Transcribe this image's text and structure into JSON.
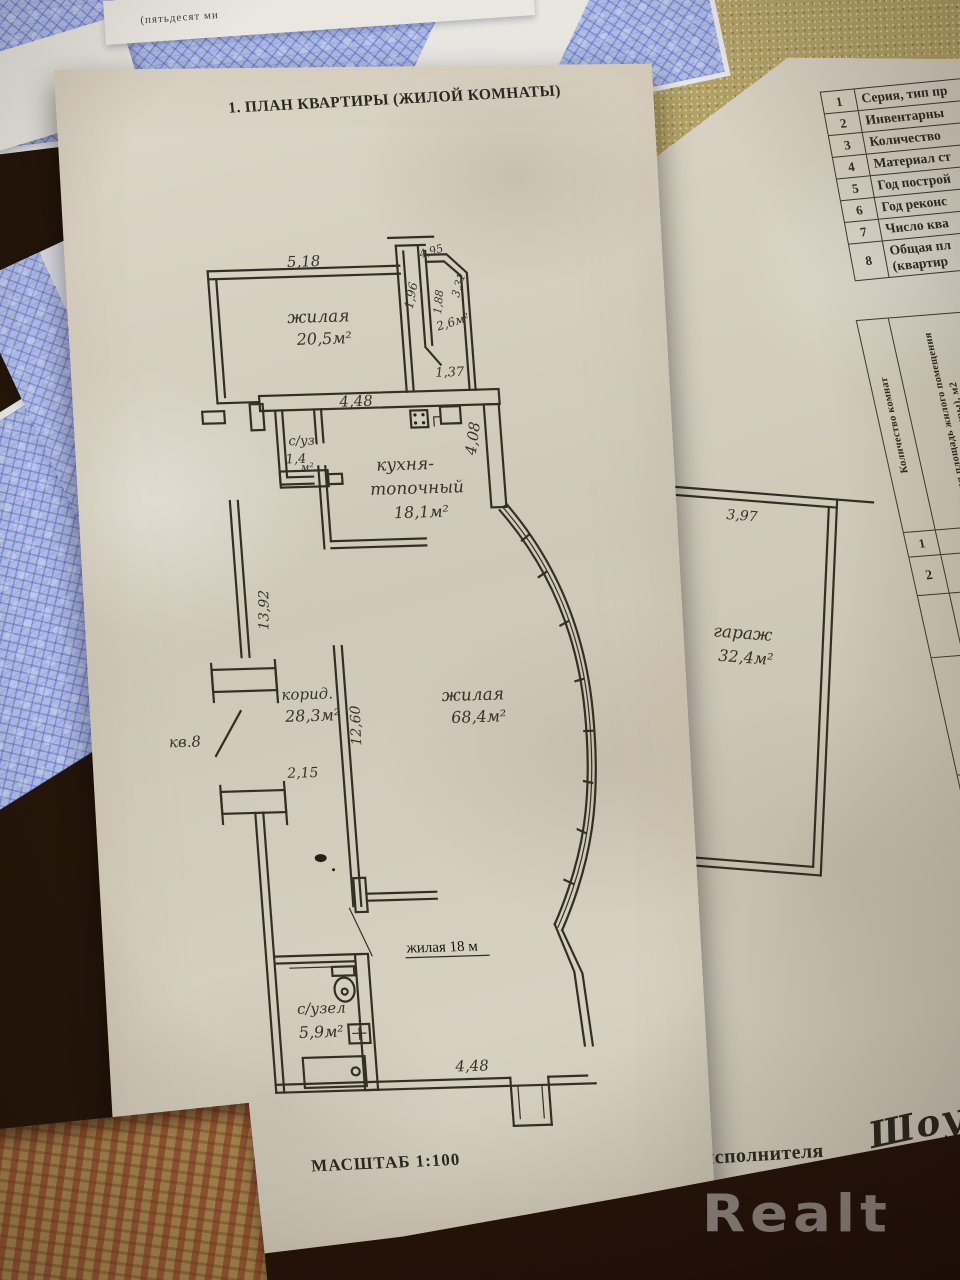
{
  "photo": {
    "watermark": "Realt"
  },
  "plan_page": {
    "title": "1. ПЛАН КВАРТИРЫ (ЖИЛОЙ КОМНАТЫ)",
    "scale": "МАСШТАБ 1:100",
    "rooms": {
      "living1_name": "жилая",
      "living1_area": "20,5м²",
      "small_room_area": "2,6м²",
      "kitchen_name1": "кухня-",
      "kitchen_name2": "топочный",
      "kitchen_area": "18,1м²",
      "wc1_name": "с/уз.",
      "wc1_area": "1,4",
      "wc1_unit": "м²",
      "corridor_name": "корид.",
      "corridor_area": "28,3м²",
      "living2_name": "жилая",
      "living2_area": "68,4м²",
      "bath_name": "с/узел",
      "bath_area": "5,9м²",
      "typed_note": "жилая 18 м",
      "apt_no": "кв.8",
      "garage_name": "гараж",
      "garage_area": "32,4м²"
    },
    "dims": {
      "top_room": "5,18",
      "top_right": "4,95",
      "shaft": "1,96",
      "small1": "1,88",
      "small2": "3,31",
      "passage": "1,37",
      "kitchen_w": "4,48",
      "kitchen_h": "4,08",
      "left_wall": "13,92",
      "mid_wall": "12,60",
      "left_gap": "2,15",
      "bottom_w": "4,48",
      "garage_w": "3,97",
      "garage_h": "8,17"
    }
  },
  "data_page": {
    "rows": [
      {
        "num": "1",
        "label": "Серия, тип пр"
      },
      {
        "num": "2",
        "label": "Инвентарны"
      },
      {
        "num": "3",
        "label": "Количество"
      },
      {
        "num": "4",
        "label": "Материал ст"
      },
      {
        "num": "5",
        "label": "Год построй"
      },
      {
        "num": "6",
        "label": "Год реконс"
      },
      {
        "num": "7",
        "label": "Число ква"
      },
      {
        "num": "8",
        "label": "Общая пл",
        "label2": "(квартир"
      }
    ],
    "col_headers": [
      "Количество комнат",
      "Общая площадь жилого помещения (квартиры), м2"
    ],
    "col_nums": [
      "1",
      "2"
    ],
    "values_row": {
      "rooms": "2",
      "area": "142"
    },
    "cell_letter": "Л",
    "signature_label": "Подпись исполнителя",
    "signature": "Шоу"
  },
  "certificate": {
    "top_fragment": "(пятьдесят ми",
    "lines": [
      "РЕС",
      "ГОСУДАРС",
      "УЩЕСТВА,",
      "твенный ко",
      "бликанское у",
      "о по государ",
      "ДЕТЕЛЬС",
      "О ГОСУ",
      "о заявлени",
      "отношен",
      "806601000",
      "ова 4-й, д",
      "луживание",
      "произвел",
      "1. перем",
      "сток (фор",
      "жданин Р",
      "ане - 51/50",
      "Прил",
      "1. зе",
      "При",
      "обремене",
      "(обремен",
      "код - 2, 1",
      "Свидет",
      "Регист"
    ]
  }
}
